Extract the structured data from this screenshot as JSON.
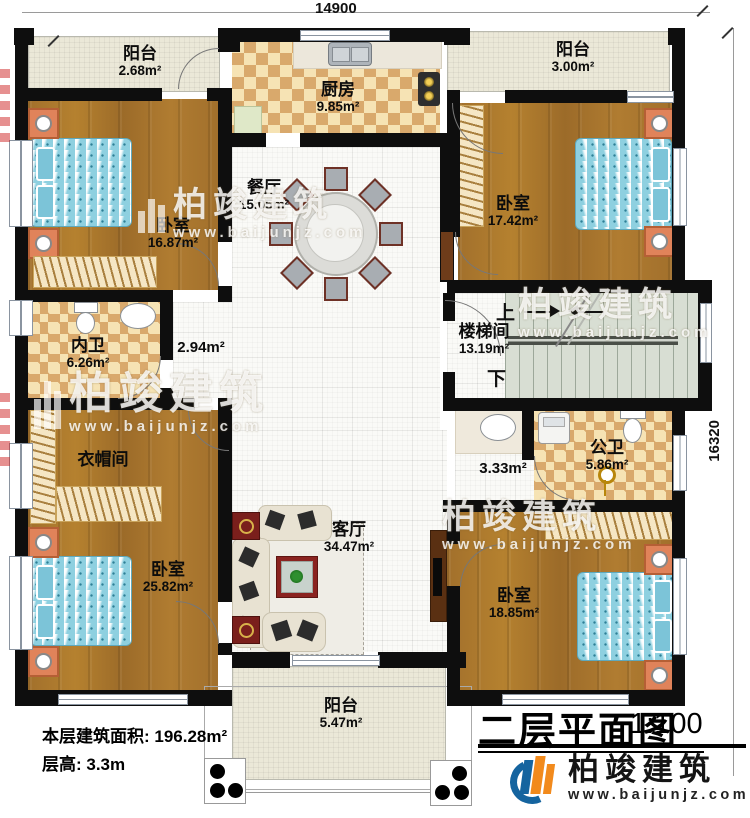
{
  "page": {
    "title": "二层平面图",
    "scale": "1:100"
  },
  "dimensions": {
    "top": "14900",
    "right": "16320"
  },
  "notes": {
    "area": "本层建筑面积: 196.28m²",
    "floor_height": "层高: 3.3m"
  },
  "stairs": {
    "up": "上",
    "down": "下"
  },
  "brand": {
    "name": "柏竣建筑",
    "url": "www.baijunjz.com"
  },
  "rooms": [
    {
      "id": "balcony-top-left",
      "name": "阳台",
      "area": "2.68m²"
    },
    {
      "id": "kitchen",
      "name": "厨房",
      "area": "9.85m²"
    },
    {
      "id": "balcony-top-right",
      "name": "阳台",
      "area": "3.00m²"
    },
    {
      "id": "bedroom-top-left",
      "name": "卧室",
      "area": "16.87m²"
    },
    {
      "id": "dining",
      "name": "餐厅",
      "area": "15.05m²"
    },
    {
      "id": "bedroom-top-right",
      "name": "卧室",
      "area": "17.42m²"
    },
    {
      "id": "bath-inner",
      "name": "内卫",
      "area": "6.26m²"
    },
    {
      "id": "hall-left",
      "name": "",
      "area": "2.94m²"
    },
    {
      "id": "stairwell",
      "name": "楼梯间",
      "area": "13.19m²"
    },
    {
      "id": "cloakroom",
      "name": "衣帽间",
      "area": ""
    },
    {
      "id": "hall-right",
      "name": "",
      "area": "3.33m²"
    },
    {
      "id": "bath-public",
      "name": "公卫",
      "area": "5.86m²"
    },
    {
      "id": "bedroom-bottom-left",
      "name": "卧室",
      "area": "25.82m²"
    },
    {
      "id": "living",
      "name": "客厅",
      "area": "34.47m²"
    },
    {
      "id": "bedroom-bottom-right",
      "name": "卧室",
      "area": "18.85m²"
    },
    {
      "id": "balcony-bottom",
      "name": "阳台",
      "area": "5.47m²"
    }
  ],
  "colors": {
    "wall": "#0e0e0e",
    "wood_floor": "#a9752f",
    "bath_checker": "#d9a96c",
    "balcony_floor": "#ebe8d8",
    "stair_floor": "#d8ded3",
    "bed": "#8ed0e0",
    "nightstand": "#e0835a",
    "logo_blue": "#15649f",
    "logo_orange": "#f28a1c",
    "title_text": "#000000",
    "watermark": "#ffffff"
  }
}
